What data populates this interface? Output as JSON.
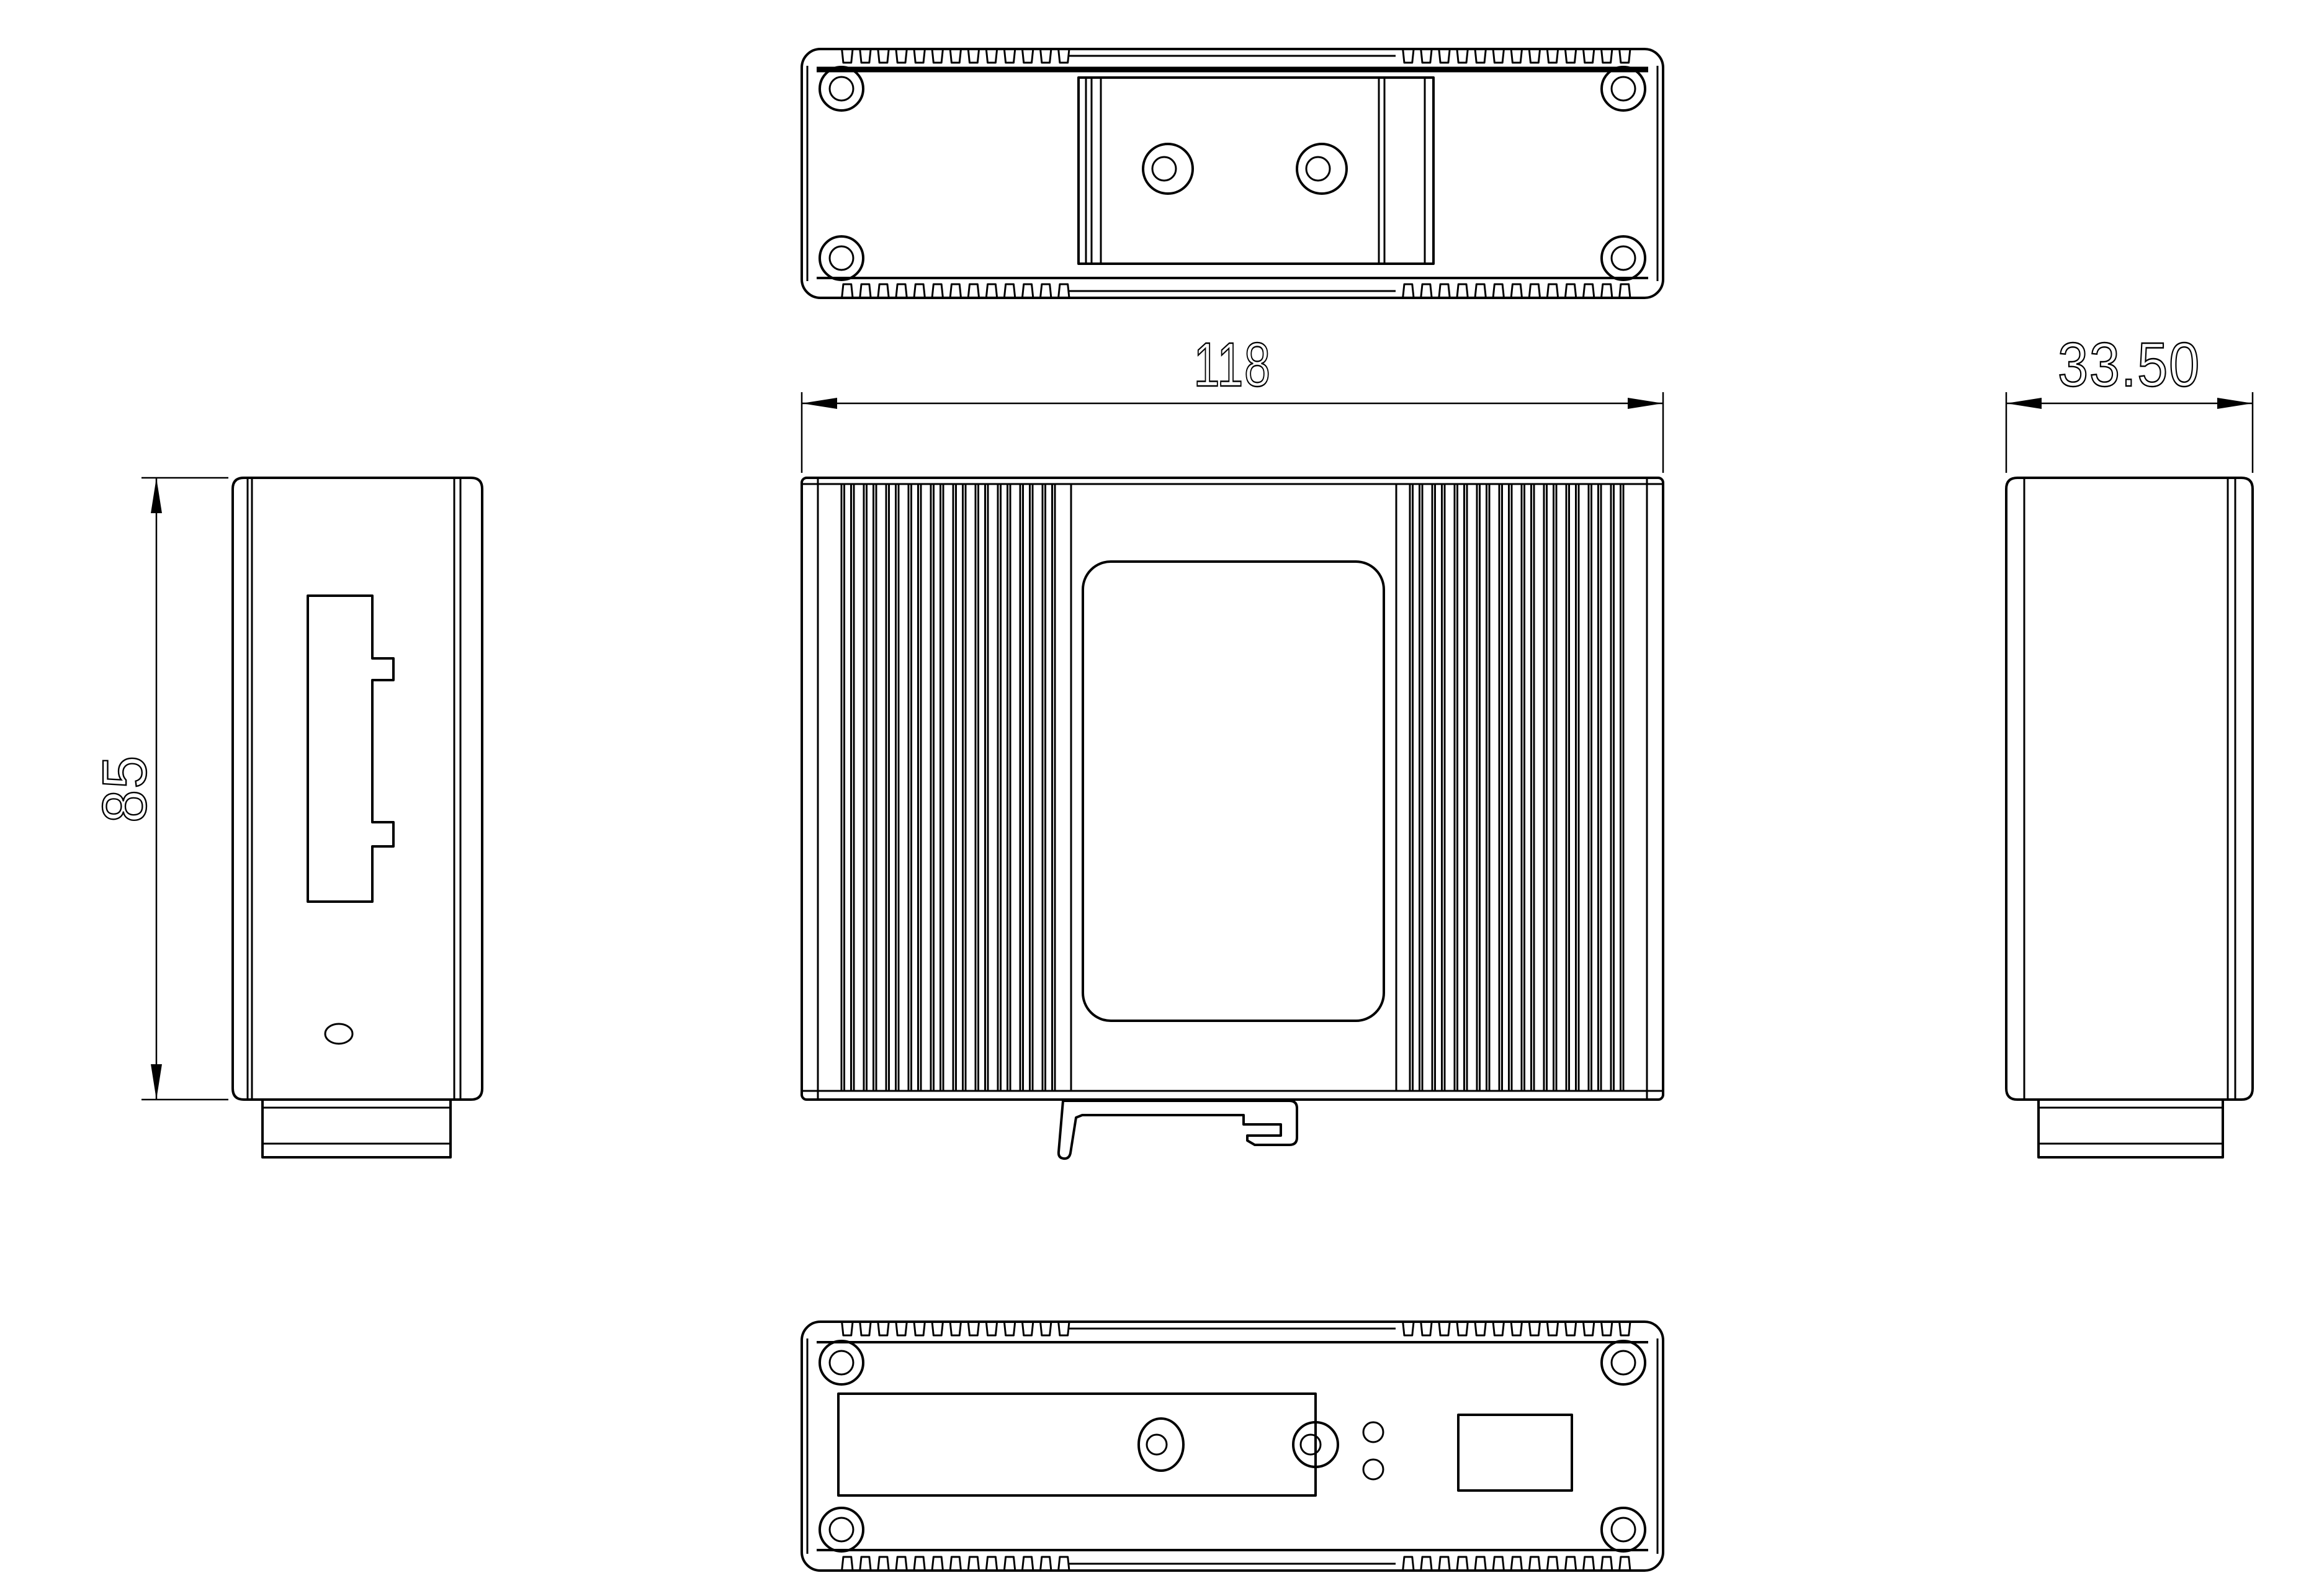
{
  "drawing": {
    "background_color": "#ffffff",
    "line_color": "#000000",
    "dimensions": {
      "front_width": {
        "label": "118"
      },
      "side_depth": {
        "label": "33.50"
      },
      "body_height": {
        "label": "85"
      }
    }
  }
}
